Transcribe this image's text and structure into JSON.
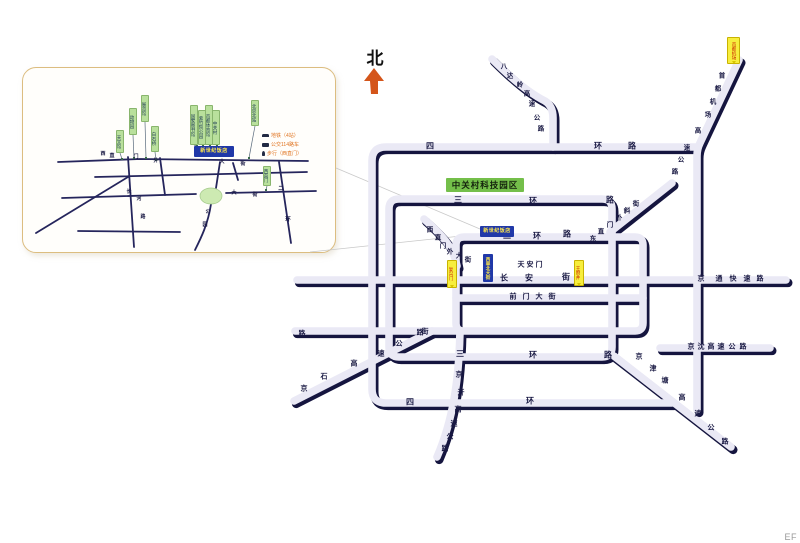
{
  "colors": {
    "glyph": "#1a1a44",
    "road": "#eae9f5",
    "road_shadow": "#15153f",
    "inset_line": "#25255c",
    "green_label_bg": "#b9e09c",
    "yellow_label_bg": "#f7ee3d",
    "blue_label_bg": "#2038a8",
    "legend_text": "#e0731f",
    "north_arrow": "#d4551a",
    "area_label_bg": "#74bf4a",
    "park_fill": "#cdeab2"
  },
  "north_indicator": {
    "label": "北"
  },
  "footer": {
    "code": "EF"
  },
  "main_map": {
    "area_label": {
      "text": "中关村科技园区",
      "x": 446,
      "y": 178,
      "w": 78,
      "h": 14
    },
    "road_labels": [
      {
        "name": "ring4-north",
        "text": "四环路",
        "size": 8,
        "chars": [
          [
            430,
            146
          ],
          [
            598,
            146
          ],
          [
            632,
            146
          ]
        ]
      },
      {
        "name": "ring3-north",
        "text": "三环路",
        "size": 8,
        "chars": [
          [
            458,
            200
          ],
          [
            533,
            201
          ],
          [
            610,
            200
          ]
        ]
      },
      {
        "name": "ring2-north",
        "text": "二环路",
        "size": 8,
        "chars": [
          [
            507,
            236
          ],
          [
            537,
            236
          ],
          [
            567,
            234
          ]
        ]
      },
      {
        "name": "ring3-south",
        "text": "三环路",
        "size": 8,
        "chars": [
          [
            460,
            354
          ],
          [
            533,
            355
          ],
          [
            608,
            355
          ]
        ]
      },
      {
        "name": "ring4-south",
        "text": "四环",
        "size": 8,
        "chars": [
          [
            410,
            402
          ],
          [
            530,
            401
          ]
        ]
      },
      {
        "name": "changan-street",
        "text": "长安街",
        "size": 8,
        "chars": [
          [
            504,
            278
          ],
          [
            529,
            278
          ],
          [
            566,
            277
          ]
        ]
      },
      {
        "name": "qianmen-street",
        "text": "前门大街",
        "size": 7,
        "chars": [
          [
            513,
            297
          ],
          [
            526,
            297
          ],
          [
            539,
            297
          ],
          [
            552,
            297
          ]
        ]
      },
      {
        "name": "tiananmen",
        "text": "天安门",
        "size": 7,
        "chars": [
          [
            521,
            265
          ],
          [
            530,
            265
          ],
          [
            539,
            265
          ]
        ]
      },
      {
        "name": "xizhimenwai-street",
        "text": "西直门外大街",
        "size": 6.5,
        "chars": [
          [
            430,
            230
          ],
          [
            438,
            238
          ],
          [
            443,
            246
          ],
          [
            450,
            252
          ],
          [
            459,
            256
          ],
          [
            468,
            260
          ]
        ]
      },
      {
        "name": "dongzhimenwai-xiejie",
        "text": "东直门外斜街",
        "size": 6.5,
        "chars": [
          [
            593,
            239
          ],
          [
            601,
            232
          ],
          [
            610,
            225
          ],
          [
            619,
            218
          ],
          [
            627,
            211
          ],
          [
            636,
            204
          ]
        ]
      },
      {
        "name": "jingtong-expressway",
        "text": "京通快速路",
        "size": 7,
        "chars": [
          [
            701,
            279
          ],
          [
            719,
            279
          ],
          [
            733,
            279
          ],
          [
            747,
            279
          ],
          [
            760,
            279
          ]
        ]
      },
      {
        "name": "jingshen-expressway",
        "text": "京沈高速公路",
        "size": 7,
        "chars": [
          [
            691,
            347
          ],
          [
            701,
            347
          ],
          [
            711,
            347
          ],
          [
            721,
            347
          ],
          [
            732,
            347
          ],
          [
            743,
            347
          ]
        ]
      },
      {
        "name": "jingjintang-expressway",
        "text": "京津塘高速公路",
        "size": 7,
        "chars": [
          [
            639,
            357
          ],
          [
            653,
            369
          ],
          [
            665,
            381
          ],
          [
            682,
            398
          ],
          [
            698,
            414
          ],
          [
            711,
            428
          ],
          [
            725,
            442
          ]
        ]
      },
      {
        "name": "jingshi-expressway",
        "text": "京石高速公路",
        "size": 7,
        "chars": [
          [
            304,
            389
          ],
          [
            324,
            377
          ],
          [
            354,
            364
          ],
          [
            381,
            354
          ],
          [
            399,
            344
          ],
          [
            420,
            333
          ]
        ]
      },
      {
        "name": "badaling-expressway",
        "text": "八达岭高速公路",
        "size": 6.5,
        "chars": [
          [
            504,
            67
          ],
          [
            510,
            76
          ],
          [
            520,
            85
          ],
          [
            527,
            94
          ],
          [
            532,
            104
          ],
          [
            537,
            118
          ],
          [
            541,
            129
          ]
        ]
      },
      {
        "name": "airport-expressway",
        "text": "首都机场高速公路",
        "size": 6.5,
        "chars": [
          [
            722,
            76
          ],
          [
            718,
            89
          ],
          [
            713,
            102
          ],
          [
            708,
            115
          ],
          [
            698,
            131
          ],
          [
            687,
            148
          ],
          [
            681,
            160
          ],
          [
            675,
            172
          ]
        ]
      },
      {
        "name": "jingkai-expressway",
        "text": "京开高速公路",
        "size": 7,
        "chars": [
          [
            459,
            375
          ],
          [
            461,
            393
          ],
          [
            458,
            410
          ],
          [
            454,
            424
          ],
          [
            450,
            437
          ],
          [
            445,
            449
          ]
        ]
      },
      {
        "name": "south-street-char",
        "text": "街",
        "size": 7,
        "chars": [
          [
            425,
            332
          ]
        ]
      },
      {
        "name": "south-street-end",
        "text": "路",
        "size": 7,
        "chars": [
          [
            302,
            334
          ]
        ]
      }
    ],
    "station_labels": [
      {
        "name": "capital-airport",
        "text": "首都机场",
        "x": 727,
        "y": 37,
        "w": 13,
        "h": 27
      },
      {
        "name": "fuxingmen",
        "text": "复兴门",
        "x": 447,
        "y": 260,
        "w": 10,
        "h": 28
      },
      {
        "name": "wangfujing",
        "text": "王府井",
        "x": 574,
        "y": 260,
        "w": 10,
        "h": 26
      }
    ],
    "dest_labels": [
      {
        "name": "hotel-marker-main",
        "text": "新世纪饭店",
        "x": 480,
        "y": 226,
        "w": 34,
        "h": 11,
        "orient": "h"
      },
      {
        "name": "xidan-street-marker",
        "text": "西单北大街",
        "x": 483,
        "y": 254,
        "w": 10,
        "h": 28,
        "orient": "v"
      }
    ]
  },
  "inset": {
    "hotel_label": {
      "text": "新世纪饭店"
    },
    "road_labels": [
      {
        "name": "inset-xizhimenwai",
        "text": "西直门外大街",
        "size": 5,
        "chars": [
          [
            103,
            154
          ],
          [
            112,
            156
          ],
          [
            136,
            157
          ],
          [
            156,
            161
          ],
          [
            222,
            162
          ],
          [
            243,
            164
          ]
        ]
      },
      {
        "name": "inset-erhuan",
        "text": "二环",
        "size": 5.5,
        "chars": [
          [
            281,
            189
          ],
          [
            288,
            220
          ]
        ]
      },
      {
        "name": "inset-changhe-road",
        "text": "长河路",
        "size": 5,
        "chars": [
          [
            129,
            192
          ],
          [
            139,
            199
          ],
          [
            143,
            217
          ]
        ]
      },
      {
        "name": "inset-south-street",
        "text": "大街",
        "size": 5,
        "chars": [
          [
            234,
            193
          ],
          [
            255,
            195
          ]
        ]
      },
      {
        "name": "inset-park-label",
        "text": "公园",
        "size": 5,
        "chars": [
          [
            208,
            212
          ],
          [
            205,
            225
          ]
        ]
      }
    ],
    "landmarks": [
      {
        "text": "天文馆",
        "x": 116,
        "y": 130,
        "h": 23,
        "target": [
          122,
          159
        ]
      },
      {
        "text": "动物园",
        "x": 129,
        "y": 108,
        "h": 27,
        "target": [
          134,
          158
        ]
      },
      {
        "text": "展览馆",
        "x": 141,
        "y": 95,
        "h": 27,
        "target": [
          146,
          158
        ]
      },
      {
        "text": "白石桥",
        "x": 151,
        "y": 126,
        "h": 26,
        "target": [
          156,
          160
        ]
      },
      {
        "text": "国家图书馆",
        "x": 190,
        "y": 105,
        "h": 40,
        "target": [
          197,
          146
        ]
      },
      {
        "text": "紫竹院公园",
        "x": 198,
        "y": 110,
        "h": 35,
        "target": [
          203,
          146
        ]
      },
      {
        "text": "首都体育馆",
        "x": 205,
        "y": 105,
        "h": 40,
        "target": [
          210,
          146
        ]
      },
      {
        "text": "中关村",
        "x": 212,
        "y": 110,
        "h": 35,
        "target": [
          217,
          146
        ]
      },
      {
        "text": "北京北站",
        "x": 251,
        "y": 100,
        "h": 26,
        "target": [
          249,
          158
        ]
      },
      {
        "text": "西直门",
        "x": 263,
        "y": 166,
        "h": 20,
        "target": [
          266,
          190
        ]
      }
    ],
    "legend": [
      {
        "icon": "car",
        "text": "地铁（4站）"
      },
      {
        "icon": "bus",
        "text": "公交114路车"
      },
      {
        "icon": "walk",
        "text": "步行（西直门）"
      }
    ]
  }
}
